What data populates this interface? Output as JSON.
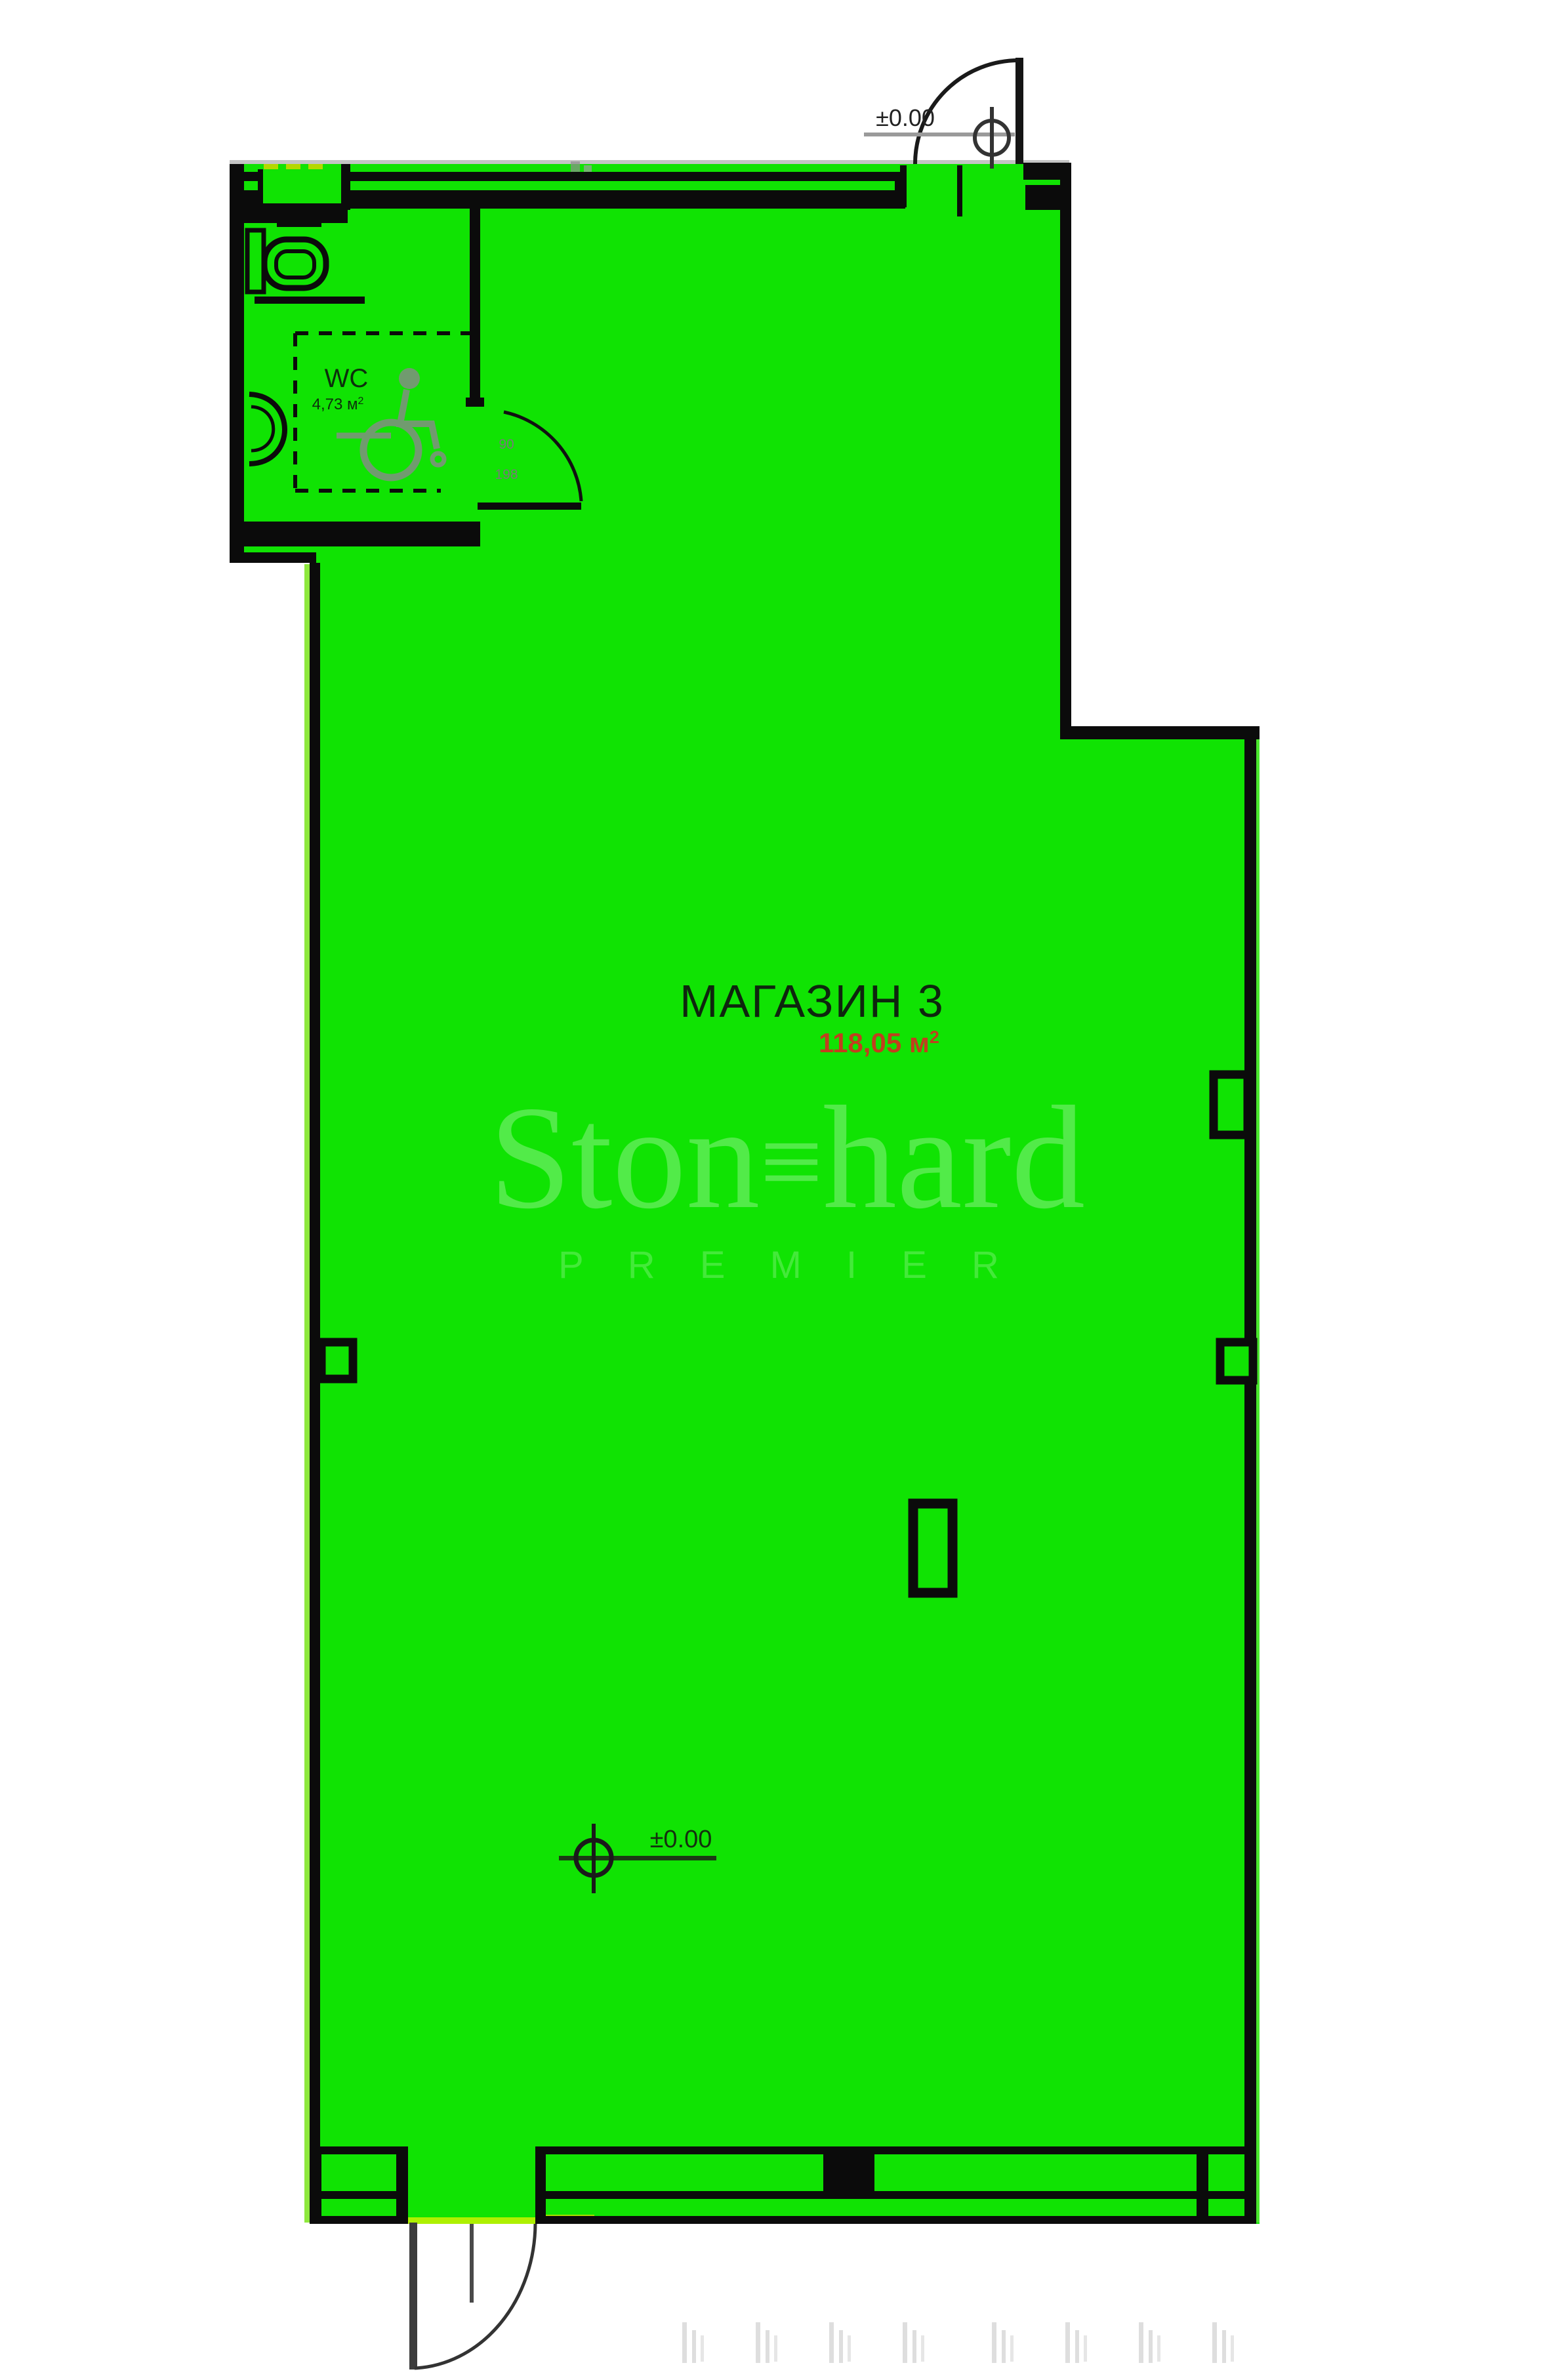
{
  "plan": {
    "room_label": "МАГАЗИН 3",
    "room_area_value": "118,05 м",
    "room_area_sup": "2",
    "wc_label": "WC",
    "wc_area_value": "4,73 м",
    "wc_area_sup": "2",
    "level_marker_top": "±0.00",
    "level_marker_floor": "±0.00",
    "wc_door_size_width": "90",
    "wc_door_size_height": "198",
    "watermark": {
      "part1": "Ston",
      "symbol": "≡",
      "part2": "hard",
      "premier": "P R E M I E R"
    },
    "colors": {
      "floor_fill": "#10e303",
      "wall": "#0b0b0b",
      "area_text": "#c13f1e",
      "label_text": "#0e260e",
      "symbol_gray": "#8a8a8a",
      "accent_yellow_green": "#aadc00"
    }
  }
}
